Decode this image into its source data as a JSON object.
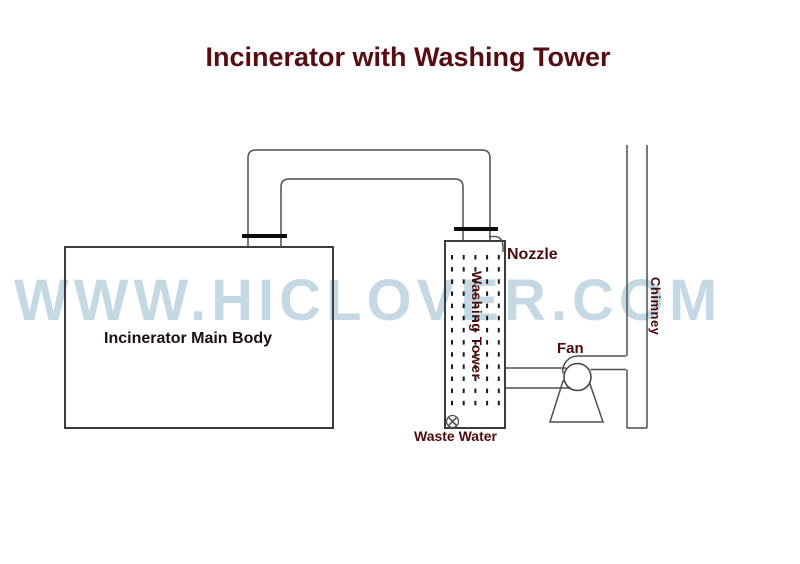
{
  "title": "Incinerator with Washing Tower",
  "watermark": "WWW.HICLOVER.COM",
  "labels": {
    "main_body": "Incinerator Main Body",
    "nozzle": "Nozzle",
    "washing_tower": "Washing Tower",
    "fan": "Fan",
    "chimney": "Chimney",
    "waste_water": "Waste Water"
  },
  "colors": {
    "title": "#570e12",
    "label": "#4c0c0c",
    "body_label": "#1d0f0f",
    "watermark": "#c5d9e4",
    "line": "#4f4f4f",
    "wall": "#3c3c3c",
    "flange": "#0d0d0d",
    "dot": "#1a1a1a"
  }
}
